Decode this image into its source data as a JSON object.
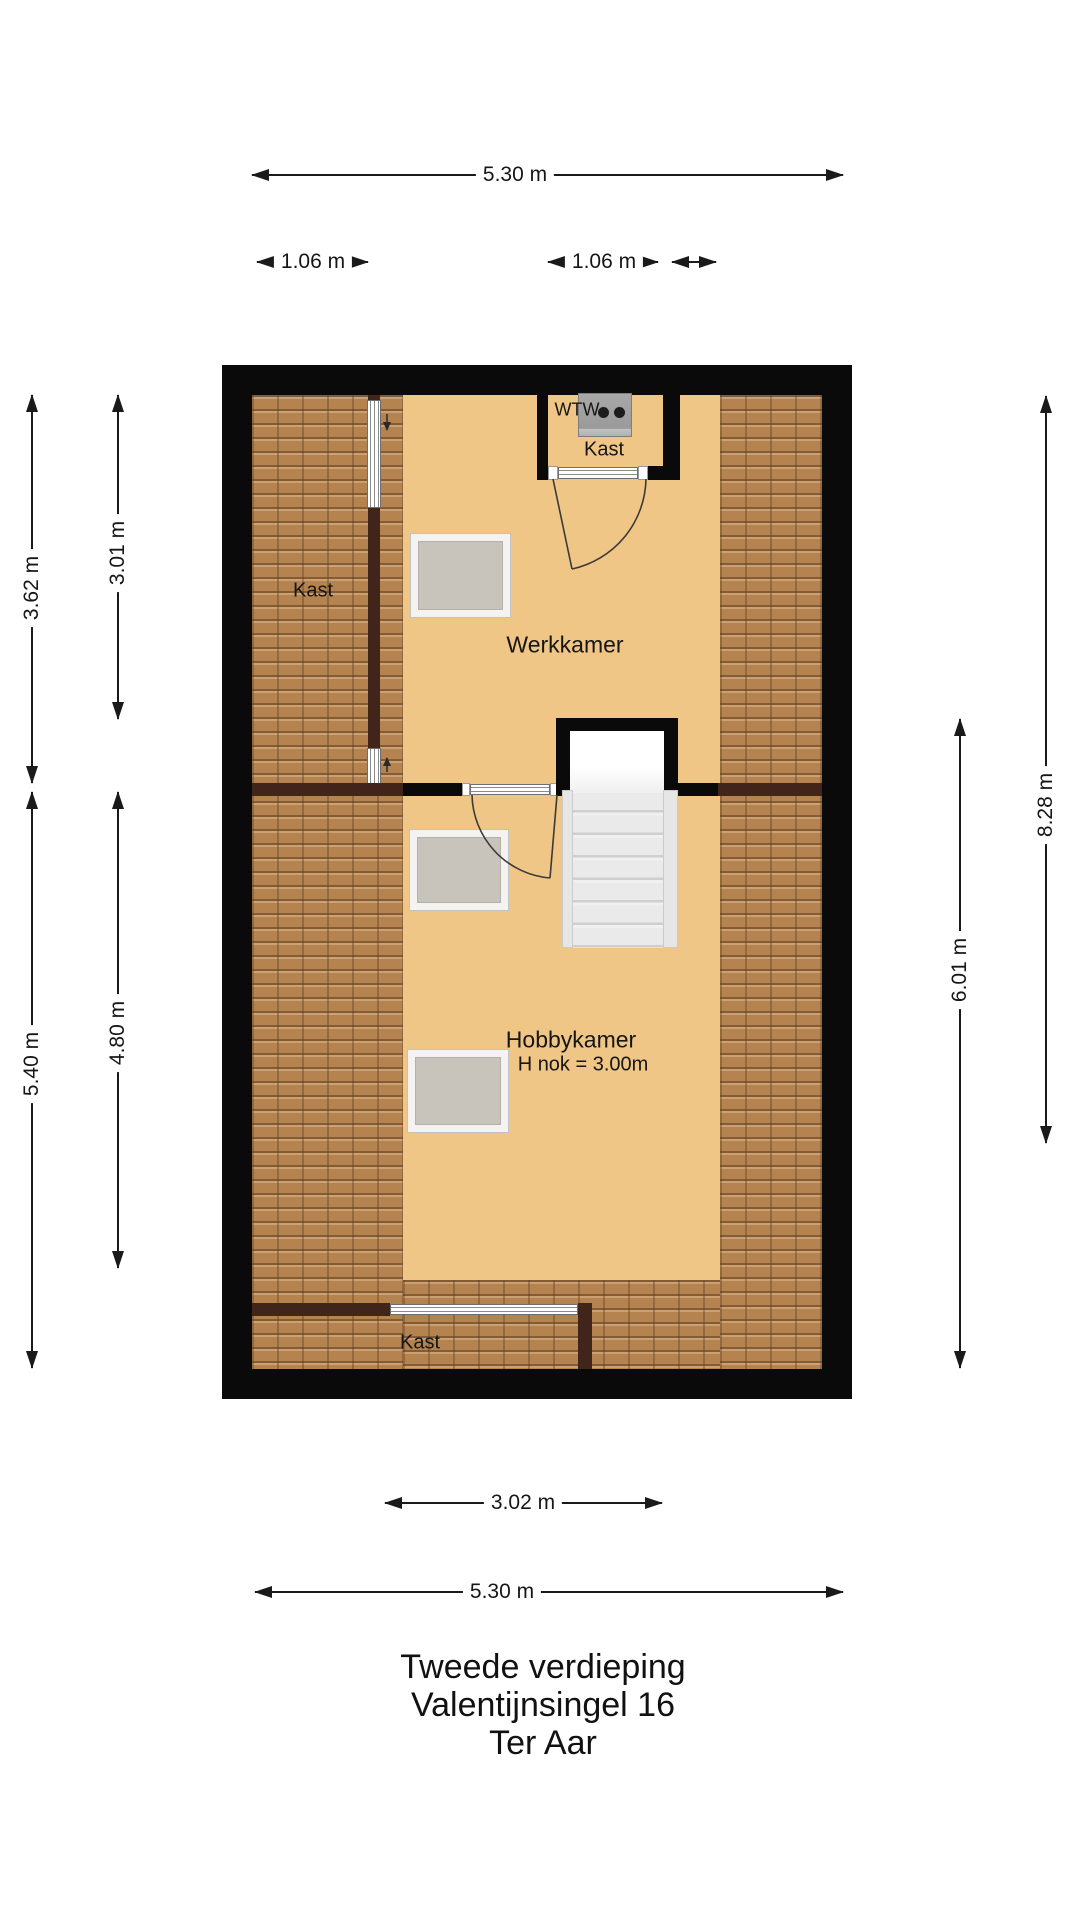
{
  "title": {
    "line1": "Tweede verdieping",
    "line2": "Valentijnsingel 16",
    "line3": "Ter Aar"
  },
  "labels": {
    "kast_left": "Kast",
    "kast_top": "Kast",
    "kast_bottom": "Kast",
    "wtw": "WTW",
    "werkkamer": "Werkkamer",
    "hobbykamer": "Hobbykamer",
    "hobbykamer_sub": "H nok = 3.00m"
  },
  "dimensions": {
    "top_width": "5.30 m",
    "top_small_left": "1.06 m",
    "top_small_right": "1.06 m",
    "left_upper_outer": "3.62 m",
    "left_upper_inner": "3.01 m",
    "left_lower_outer": "5.40 m",
    "left_lower_inner": "4.80 m",
    "right_outer": "8.28 m",
    "right_inner": "6.01 m",
    "bottom_inner": "3.02 m",
    "bottom_width": "5.30 m"
  },
  "colors": {
    "floor": "#efc685",
    "roof_tiles": "#b5834f",
    "wall_black": "#0a0a0a",
    "wall_brown": "#41251a",
    "skylight": "#c9c4bb",
    "dimension_line": "#1a1a1a"
  }
}
